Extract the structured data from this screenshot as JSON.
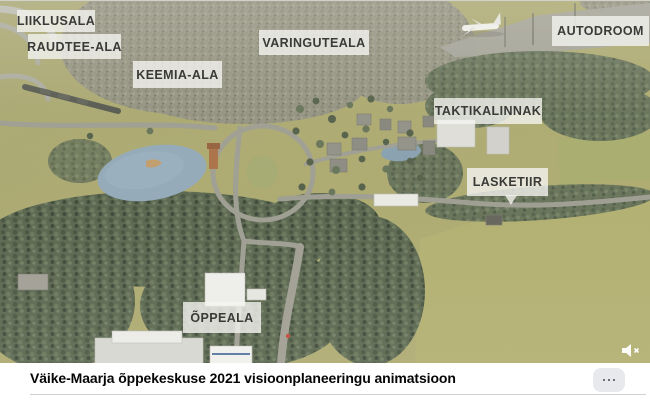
{
  "player": {
    "labels": [
      "LIIKLUSALA",
      "RAUDTEE-ALA",
      "KEEMIA-ALA",
      "VARINGUTEALA",
      "AUTODROOM",
      "TAKTIKALINNAK",
      "LASKETIIR",
      "ÕPPEALA"
    ],
    "mute_icon": "muted-speaker",
    "scene_description": "aerial 3d render of training campus"
  },
  "footer": {
    "title": "Väike-Maarja õppekeskuse 2021 visioonplaneeringu animatsioon",
    "more_icon": "three-dots"
  },
  "colors": {
    "label_bg": "rgba(244,244,240,0.80)",
    "label_text": "#3a3a38",
    "field_green": "#a7a466",
    "forest_near": "#4e5c43",
    "forest_far": "#8d8c7a",
    "water_blue": "#8ba4b6",
    "footer_bg": "#ffffff",
    "title_text": "#050505",
    "more_button_bg": "#e7e9ed",
    "divider": "#ced0d4"
  }
}
